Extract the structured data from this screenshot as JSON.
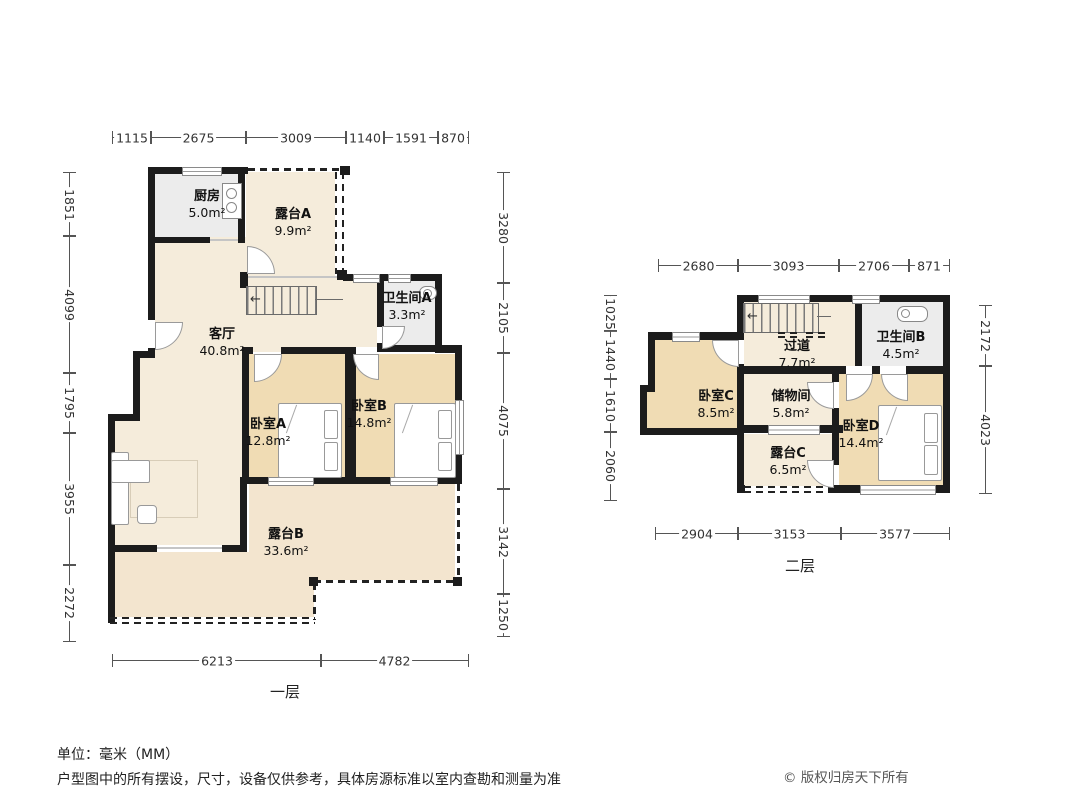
{
  "title": "户型图",
  "floor1": {
    "label": "一层",
    "rooms": {
      "kitchen": {
        "name": "厨房",
        "area": "5.0m²"
      },
      "terrace_a": {
        "name": "露台A",
        "area": "9.9m²"
      },
      "living": {
        "name": "客厅",
        "area": "40.8m²"
      },
      "bath_a": {
        "name": "卫生间A",
        "area": "3.3m²"
      },
      "bed_a": {
        "name": "卧室A",
        "area": "12.8m²"
      },
      "bed_b": {
        "name": "卧室B",
        "area": "14.8m²"
      },
      "terrace_b": {
        "name": "露台B",
        "area": "33.6m²"
      }
    },
    "dims_top": [
      "1115",
      "2675",
      "3009",
      "1140",
      "1591",
      "870"
    ],
    "dims_left": [
      "1851",
      "4099",
      "1795",
      "3955",
      "2272"
    ],
    "dims_right": [
      "3280",
      "2105",
      "4075",
      "3142",
      "1250"
    ],
    "dims_bottom": [
      "6213",
      "4782"
    ]
  },
  "floor2": {
    "label": "二层",
    "rooms": {
      "hallway": {
        "name": "过道",
        "area": "7.7m²"
      },
      "bath_b": {
        "name": "卫生间B",
        "area": "4.5m²"
      },
      "bed_c": {
        "name": "卧室C",
        "area": "8.5m²"
      },
      "storage": {
        "name": "储物间",
        "area": "5.8m²"
      },
      "terrace_c": {
        "name": "露台C",
        "area": "6.5m²"
      },
      "bed_d": {
        "name": "卧室D",
        "area": "14.4m²"
      }
    },
    "dims_top": [
      "2680",
      "3093",
      "2706",
      "871"
    ],
    "dims_left": [
      "1025",
      "1440",
      "1610",
      "2060"
    ],
    "dims_right": [
      "2172",
      "4023"
    ],
    "dims_bottom": [
      "2904",
      "3153",
      "3577"
    ]
  },
  "footer": {
    "unit": "单位：毫米（MM）",
    "disclaimer": "户型图中的所有摆设，尺寸，设备仅供参考，具体房源标准以室内查勘和测量为准",
    "copyright": "© 版权归房天下所有"
  },
  "colors": {
    "wall": "#1c1c1c",
    "floor_light": "#f5ecdb",
    "floor_tan": "#f0dcb4",
    "floor_gray": "#ececec",
    "floor_terrace": "#f3e5cf"
  }
}
